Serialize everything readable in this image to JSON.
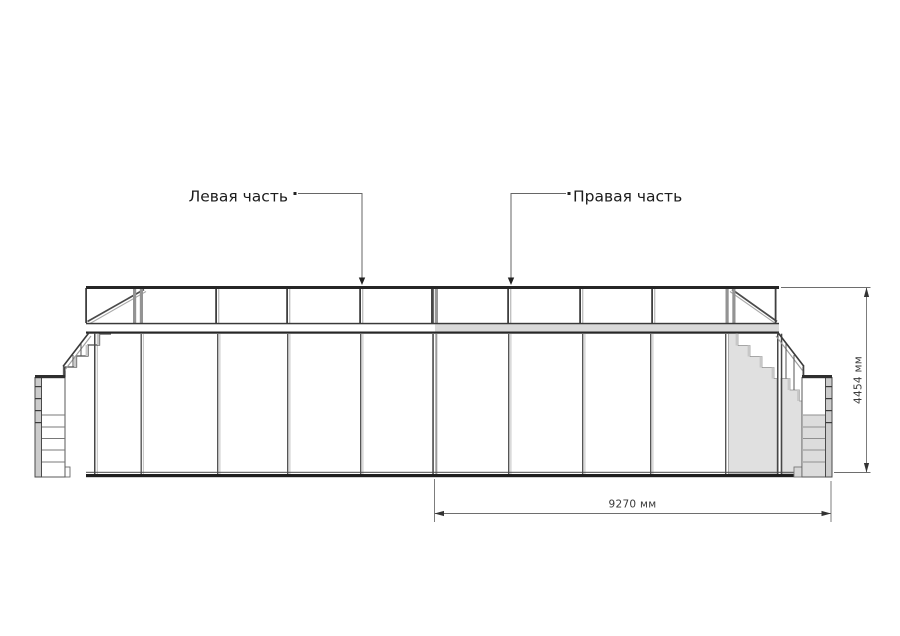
{
  "drawing": {
    "type": "front-elevation",
    "description": "Stage platform elevation with side staircases"
  },
  "annotations": {
    "left_part": "Левая часть",
    "right_part": "Правая часть"
  },
  "dimensions": {
    "overall_width": "9270 мм",
    "overall_height": "4454 мм"
  },
  "colors": {
    "background": "#ffffff",
    "line_dark": "#2e2e2e",
    "line_gray": "#9e9e9e",
    "highlight_fill": "#e0e0e0",
    "dimension_line": "#6e6e6e"
  }
}
